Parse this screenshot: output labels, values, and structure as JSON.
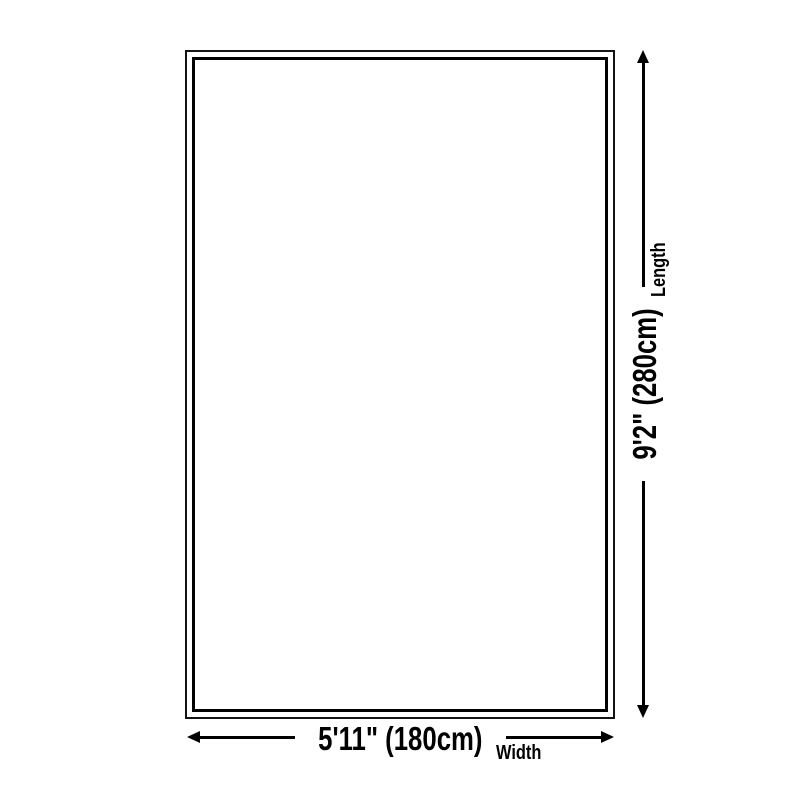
{
  "diagram": {
    "type": "product-size-diagram",
    "width_dimension": {
      "value": "5'11\" (180cm)",
      "label": "Width"
    },
    "length_dimension": {
      "value": "9'2\" (280cm)",
      "label": "Length"
    }
  },
  "icons": {
    "arrowhead_left": "triangle-left",
    "arrowhead_right": "triangle-right",
    "arrowhead_up": "triangle-up",
    "arrowhead_down": "triangle-down"
  },
  "colors": {
    "ink": "#000000",
    "rug_outer_border": "#141414",
    "background": "#ffffff"
  }
}
